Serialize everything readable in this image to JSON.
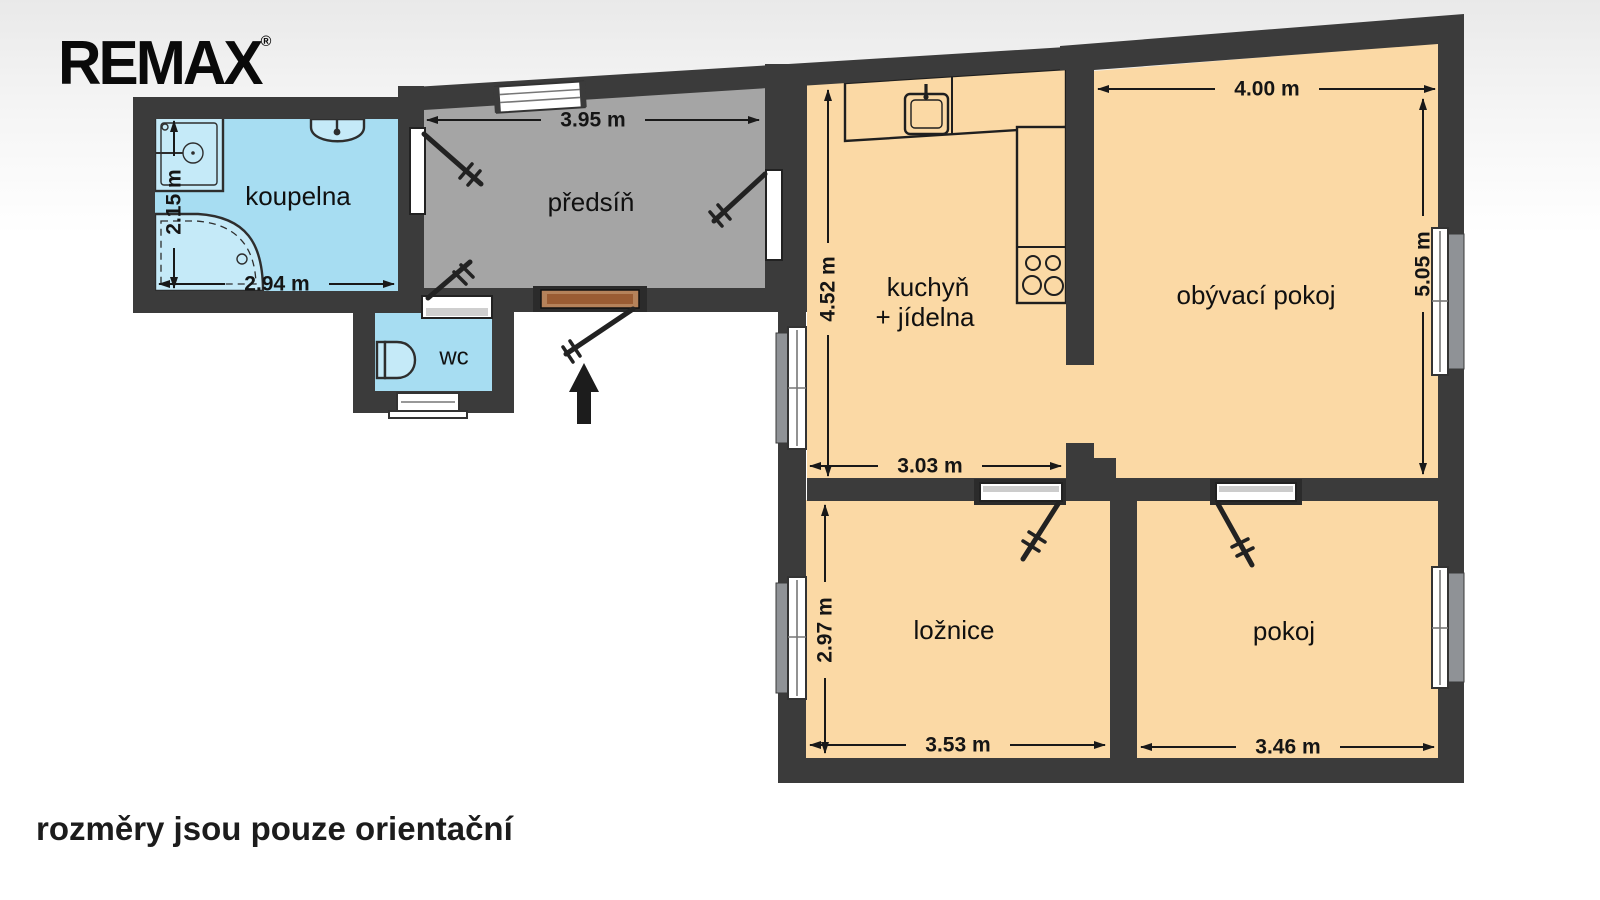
{
  "logo": {
    "text": "REMAX",
    "registered_mark": "®"
  },
  "footer": {
    "disclaimer": "rozměry jsou pouze orientační"
  },
  "floor_plan": {
    "rooms": {
      "koupelna": {
        "label": "koupelna",
        "height": "2.15 m",
        "width": "2.94 m"
      },
      "wc": {
        "label": "wc"
      },
      "predsin": {
        "label": "předsíň",
        "width": "3.95 m"
      },
      "kuchyn": {
        "label_line1": "kuchyň",
        "label_line2": "+ jídelna",
        "height": "4.52 m",
        "width": "3.03 m"
      },
      "obyvaci_pokoj": {
        "label": "obývací pokoj",
        "width": "4.00 m",
        "height": "5.05 m"
      },
      "loznice": {
        "label": "ložnice",
        "height": "2.97 m",
        "width": "3.53 m"
      },
      "pokoj": {
        "label": "pokoj",
        "width": "3.46 m"
      }
    },
    "colors": {
      "wall": "#3b3b3b",
      "wet_rooms": "#a7ddf2",
      "hallway": "#a5a5a5",
      "living_rooms": "#fbd9a5",
      "fixtures": "#c5eaf8",
      "entrance_door": "#b5825a"
    }
  }
}
